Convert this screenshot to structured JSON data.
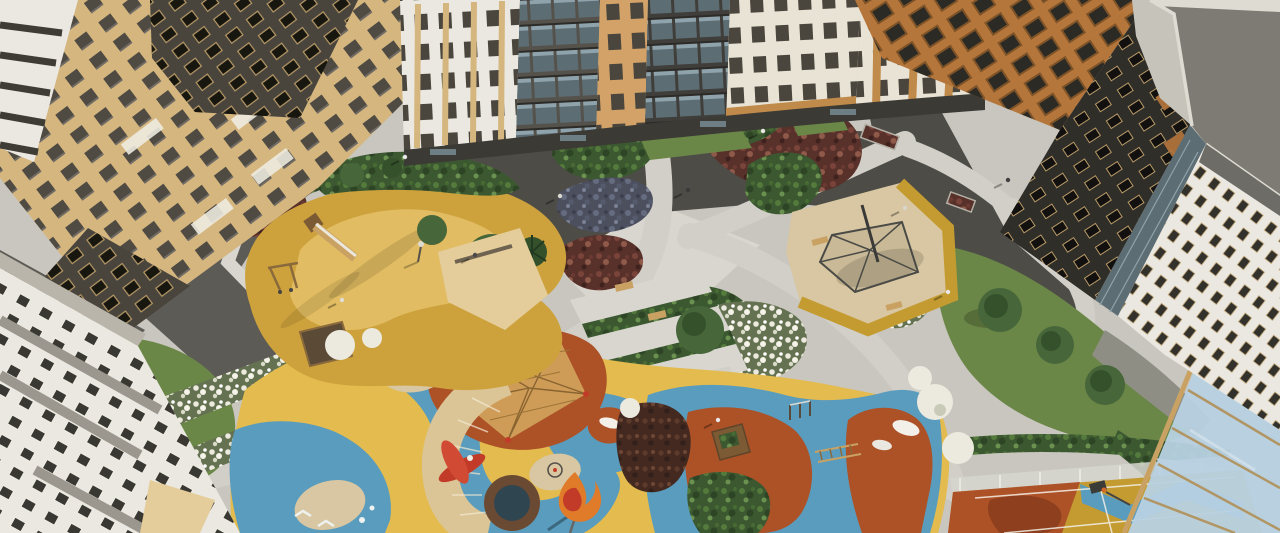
{
  "scene": {
    "type": "architectural-3d-render",
    "setting": "aerial bird's-eye view of a residential complex courtyard",
    "style": "daytime 3D visualization, no text or UI elements visible"
  },
  "palette": {
    "paverBase": "#c8c6be",
    "paverLight": "#d8d6ce",
    "paverPath": "#d1cfc7",
    "asphaltDark": "#4d4c47",
    "asphaltMed": "#5d5b55",
    "soilDark": "#38352c",
    "grass": "#6b8748",
    "grassShade": "#54703c",
    "blossom": "#eceadf",
    "treeGreen": "#47663a",
    "treeDark": "#35512c",
    "ochre": "#cda23c",
    "ochreLight": "#e3bf66",
    "mustard": "#c49b31",
    "sand": "#d8c7a2",
    "yellowRubber": "#e3bb4e",
    "blueRubber": "#5a9cbd",
    "rustRed": "#ad5127",
    "rustDark": "#8e3f1d",
    "deckBeige": "#dbc596",
    "woodTan": "#c9a263",
    "woodDark": "#7c5a34",
    "netTan": "#cf9f5a",
    "redEquip": "#c23b28",
    "orangeFlame": "#e07b2a",
    "poolRing": "#6b4a33",
    "poolWater": "#2f4650",
    "beigeWall": "#d5b67f",
    "beigeLight": "#e4cd9a",
    "whiteWall": "#eae8e0",
    "creamWall": "#e9e3d5",
    "darkWall": "#49453d",
    "charcoal": "#302e29",
    "orangeBldg": "#b5763c",
    "tanBldg": "#d2a268",
    "glassDark": "#5d6d74",
    "glassBlue": "#b7d1e1",
    "roofGray": "#7d7b74",
    "parapet": "#dedbd2",
    "grayPanel": "#9b978e",
    "pebble": "#8f8e85",
    "fence": "#d6d6cf",
    "lineWhite": "#ebe9e2",
    "shadow": "#00000040"
  },
  "elements": {
    "buildings": [
      "left beige apartment block with dark glazed wings",
      "lower-left white apartment block",
      "upper row of white, tan and glazed apartment facades",
      "upper-right building with orange window frames",
      "dark high-rise tower with light-framed windows",
      "gray corner tower with large flat roof",
      "white wing building with small windows"
    ],
    "courtyard": [
      "light paver pedestrian paths crossing the plaza",
      "dark asphalt service areas near building entrances",
      "stepped seating terraces with hedge strips",
      "planting beds: green shrubs, burgundy flowers, purple groundcover, white blossom",
      "lawns with round trees and a spruce"
    ],
    "play_areas": [
      "ochre rubber playground with wooden slide, swing frame and sandbox",
      "sand play area with cone climbing-net structure",
      "large playground with yellow, blue and terracotta rubber surfacing",
      "tan climbing-net pyramid on terracotta blob",
      "red airplane play sculpture",
      "curved wooden deck stairs",
      "round splash pool",
      "flame play sculpture",
      "outdoor fitness bars and ladder",
      "blue ponds with islands and white boat shapes",
      "basketball court with rust, yellow and blue chevron surfacing",
      "glass pergola canopy over the court edge"
    ],
    "figures": "small pedestrians on paths"
  }
}
